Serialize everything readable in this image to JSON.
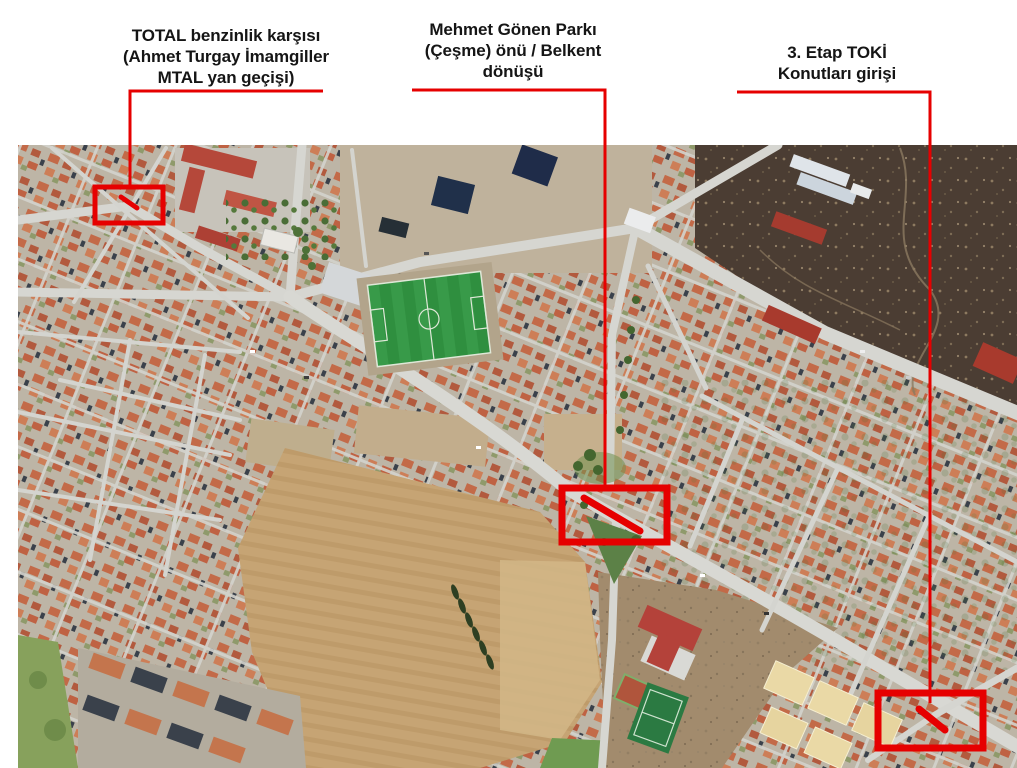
{
  "page": {
    "background_color": "#ffffff"
  },
  "annotations": {
    "accent_color": "#e60000",
    "text_color": "#151515",
    "labels": [
      {
        "id": "total-station",
        "lines": [
          "TOTAL benzinlik karşısı",
          "(Ahmet Turgay İmamgiller",
          "MTAL yan geçişi)"
        ]
      },
      {
        "id": "mehmet-gonen-park",
        "lines": [
          "Mehmet Gönen Parkı",
          "(Çeşme) önü / Belkent",
          "dönüşü"
        ]
      },
      {
        "id": "toki-entrance",
        "lines": [
          "3. Etap TOKİ",
          "Konutları girişi"
        ]
      }
    ]
  },
  "map": {
    "kind": "satellite-aerial-photo",
    "marker_color": "#e60000"
  }
}
